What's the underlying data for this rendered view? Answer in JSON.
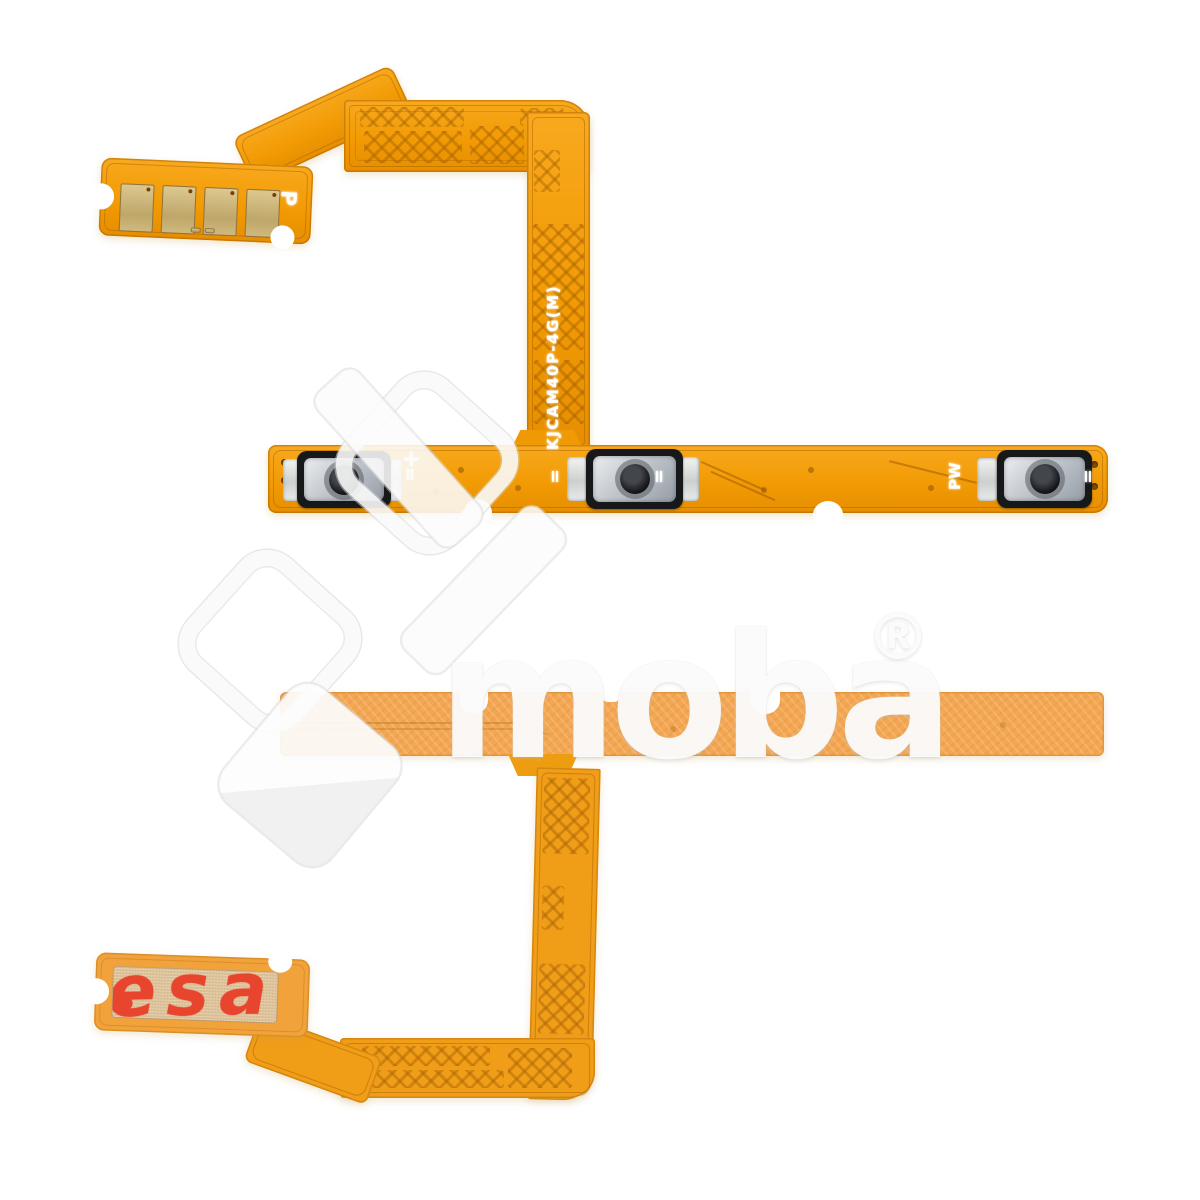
{
  "photo": {
    "background_color": "#FFFFFF"
  },
  "watermark": {
    "brand": "moba",
    "registered": "®"
  },
  "front_flex": {
    "connector_marking": "P",
    "model_code": "KJCAM40P-4G(M)",
    "plus_marking": "+",
    "tick_marking": "=",
    "power_marking": "PW"
  },
  "back_flex": {
    "sticker_text": "esa"
  },
  "colors": {
    "flex_front_orange": "#F29B04",
    "flex_back_strip_orange": "#F4A753",
    "flex_back_dark_orange": "#F09D18",
    "contact_gold": "#C9AF74",
    "sticker_tan": "#DCC197",
    "sticker_print_red": "#E8452E",
    "switch_frame_black": "#17181A",
    "switch_dome_silver": "#C2C7CD",
    "marking_white": "#FFFFFF"
  }
}
